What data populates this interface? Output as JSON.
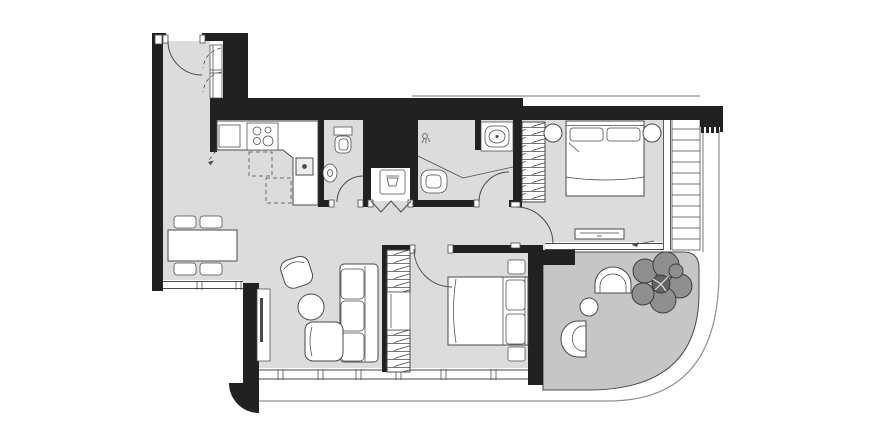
{
  "plan": {
    "type": "apartment-floor-plan",
    "title": "2-bedroom apartment floor plan with terrace",
    "canvas_width": 890,
    "canvas_height": 440
  },
  "palette": {
    "background": "#ffffff",
    "floor": "#dcdcdc",
    "terrace": "#c6c6c6",
    "wall": "#212121",
    "line": "#4a4a4a",
    "furniture_fill": "#ffffff",
    "facade": "#8f8f8f",
    "tree": "#8f8f8f",
    "tree_core": "#636363"
  },
  "rooms": [
    {
      "name": "entry-hall"
    },
    {
      "name": "kitchen"
    },
    {
      "name": "dining-area"
    },
    {
      "name": "living-room"
    },
    {
      "name": "guest-wc"
    },
    {
      "name": "laundry-closet"
    },
    {
      "name": "bathroom"
    },
    {
      "name": "hallway"
    },
    {
      "name": "bedroom-1"
    },
    {
      "name": "bedroom-2"
    },
    {
      "name": "balcony"
    },
    {
      "name": "terrace"
    }
  ],
  "fixtures": [
    {
      "name": "entrance-door",
      "count": 1
    },
    {
      "name": "entry-closet",
      "count": 1
    },
    {
      "name": "refrigerator",
      "count": 1
    },
    {
      "name": "cooktop-4-burner",
      "count": 1
    },
    {
      "name": "kitchen-sink",
      "count": 1
    },
    {
      "name": "overhead-cabinet-dashed",
      "count": 2
    },
    {
      "name": "toilet",
      "count": 2
    },
    {
      "name": "wall-basin",
      "count": 1
    },
    {
      "name": "washing-machine",
      "count": 1
    },
    {
      "name": "bifold-doors",
      "count": 1
    },
    {
      "name": "shower-head",
      "count": 1
    },
    {
      "name": "shower-glass-partition",
      "count": 1
    },
    {
      "name": "vanity-sink",
      "count": 1
    },
    {
      "name": "wardrobe-hatched",
      "count": 3
    },
    {
      "name": "double-bed",
      "count": 2
    },
    {
      "name": "nightstand",
      "count": 4
    },
    {
      "name": "dresser",
      "count": 1
    },
    {
      "name": "dining-table",
      "count": 1
    },
    {
      "name": "dining-chair",
      "count": 4
    },
    {
      "name": "armchair",
      "count": 1
    },
    {
      "name": "coffee-table",
      "count": 1
    },
    {
      "name": "corner-sofa",
      "count": 1
    },
    {
      "name": "tv-panel",
      "count": 1
    },
    {
      "name": "terrace-arch-chair",
      "count": 2
    },
    {
      "name": "terrace-table",
      "count": 1
    },
    {
      "name": "tree",
      "count": 1
    },
    {
      "name": "window-band",
      "count": 4
    },
    {
      "name": "deck-boards",
      "count": 1
    }
  ]
}
